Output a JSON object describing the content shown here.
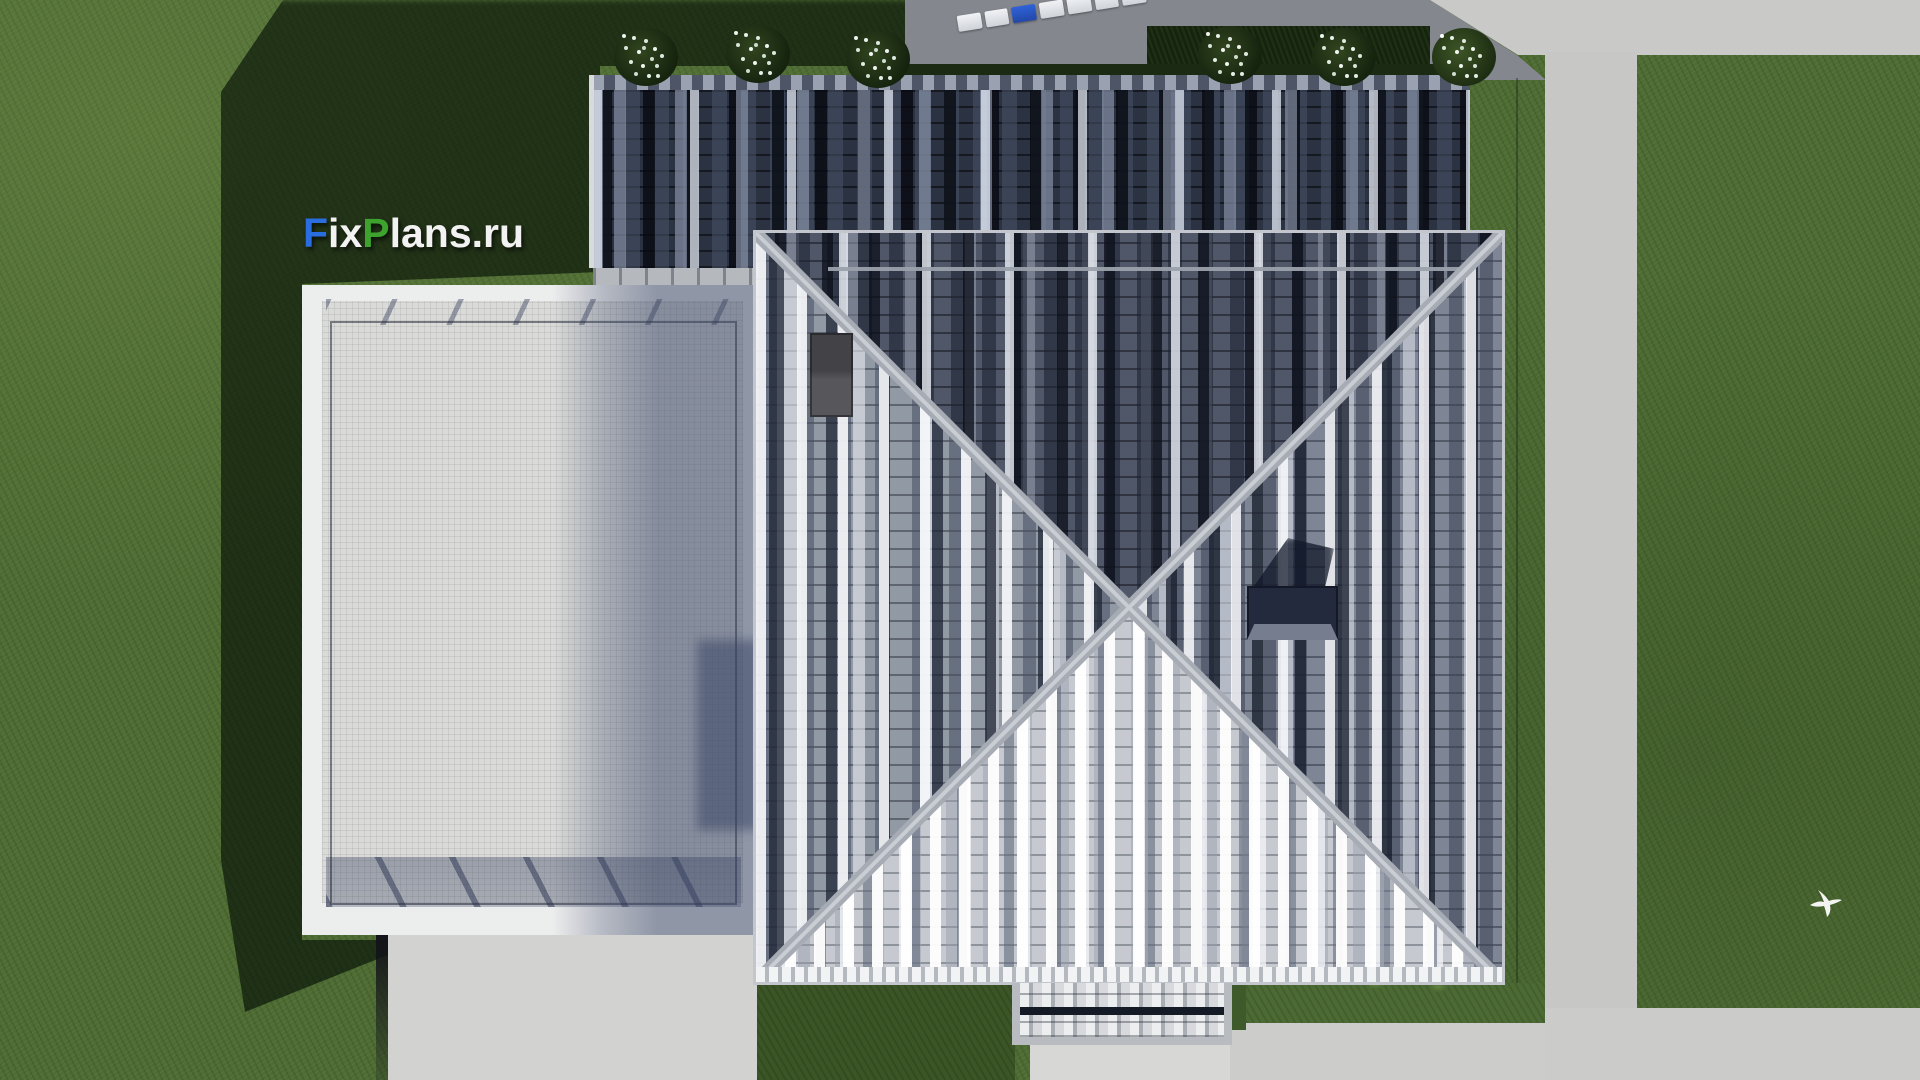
{
  "logo": {
    "text_full": "FixPlans.ru",
    "part_f": "F",
    "part_ix": "ix",
    "part_p": "P",
    "part_rest": "lans.ru"
  },
  "colors": {
    "logo_blue": "#2a6de0",
    "logo_green": "#3da22e",
    "logo_white": "#f2f2f2",
    "grass_sunlit": "#4e6c34",
    "grass_shadow": "#1d2f17",
    "dark_roof_tiles": "#2b3242",
    "main_roof_light_face": "#c6c9cf",
    "main_roof_medium_face": "#9199a4",
    "main_roof_dark_face": "#4f5768",
    "ridge_cap": "#a6abb4",
    "terrace_paving": "#dadbd9",
    "terrace_coping": "#eceded",
    "concrete_path": "#c7c7c5",
    "driveway_shadowed": "#85878e",
    "chimney_dark": "#232a3e",
    "plank_blue": "#2f62d8"
  },
  "scene": {
    "objects": [
      "lawn",
      "hip-roof",
      "dark-tile-roof",
      "terrace",
      "chimney",
      "roof-hatch",
      "porch-canopy",
      "garden-path",
      "driveway",
      "plaza",
      "flower-bushes",
      "hedge",
      "paver-planks",
      "flying-bird"
    ]
  }
}
